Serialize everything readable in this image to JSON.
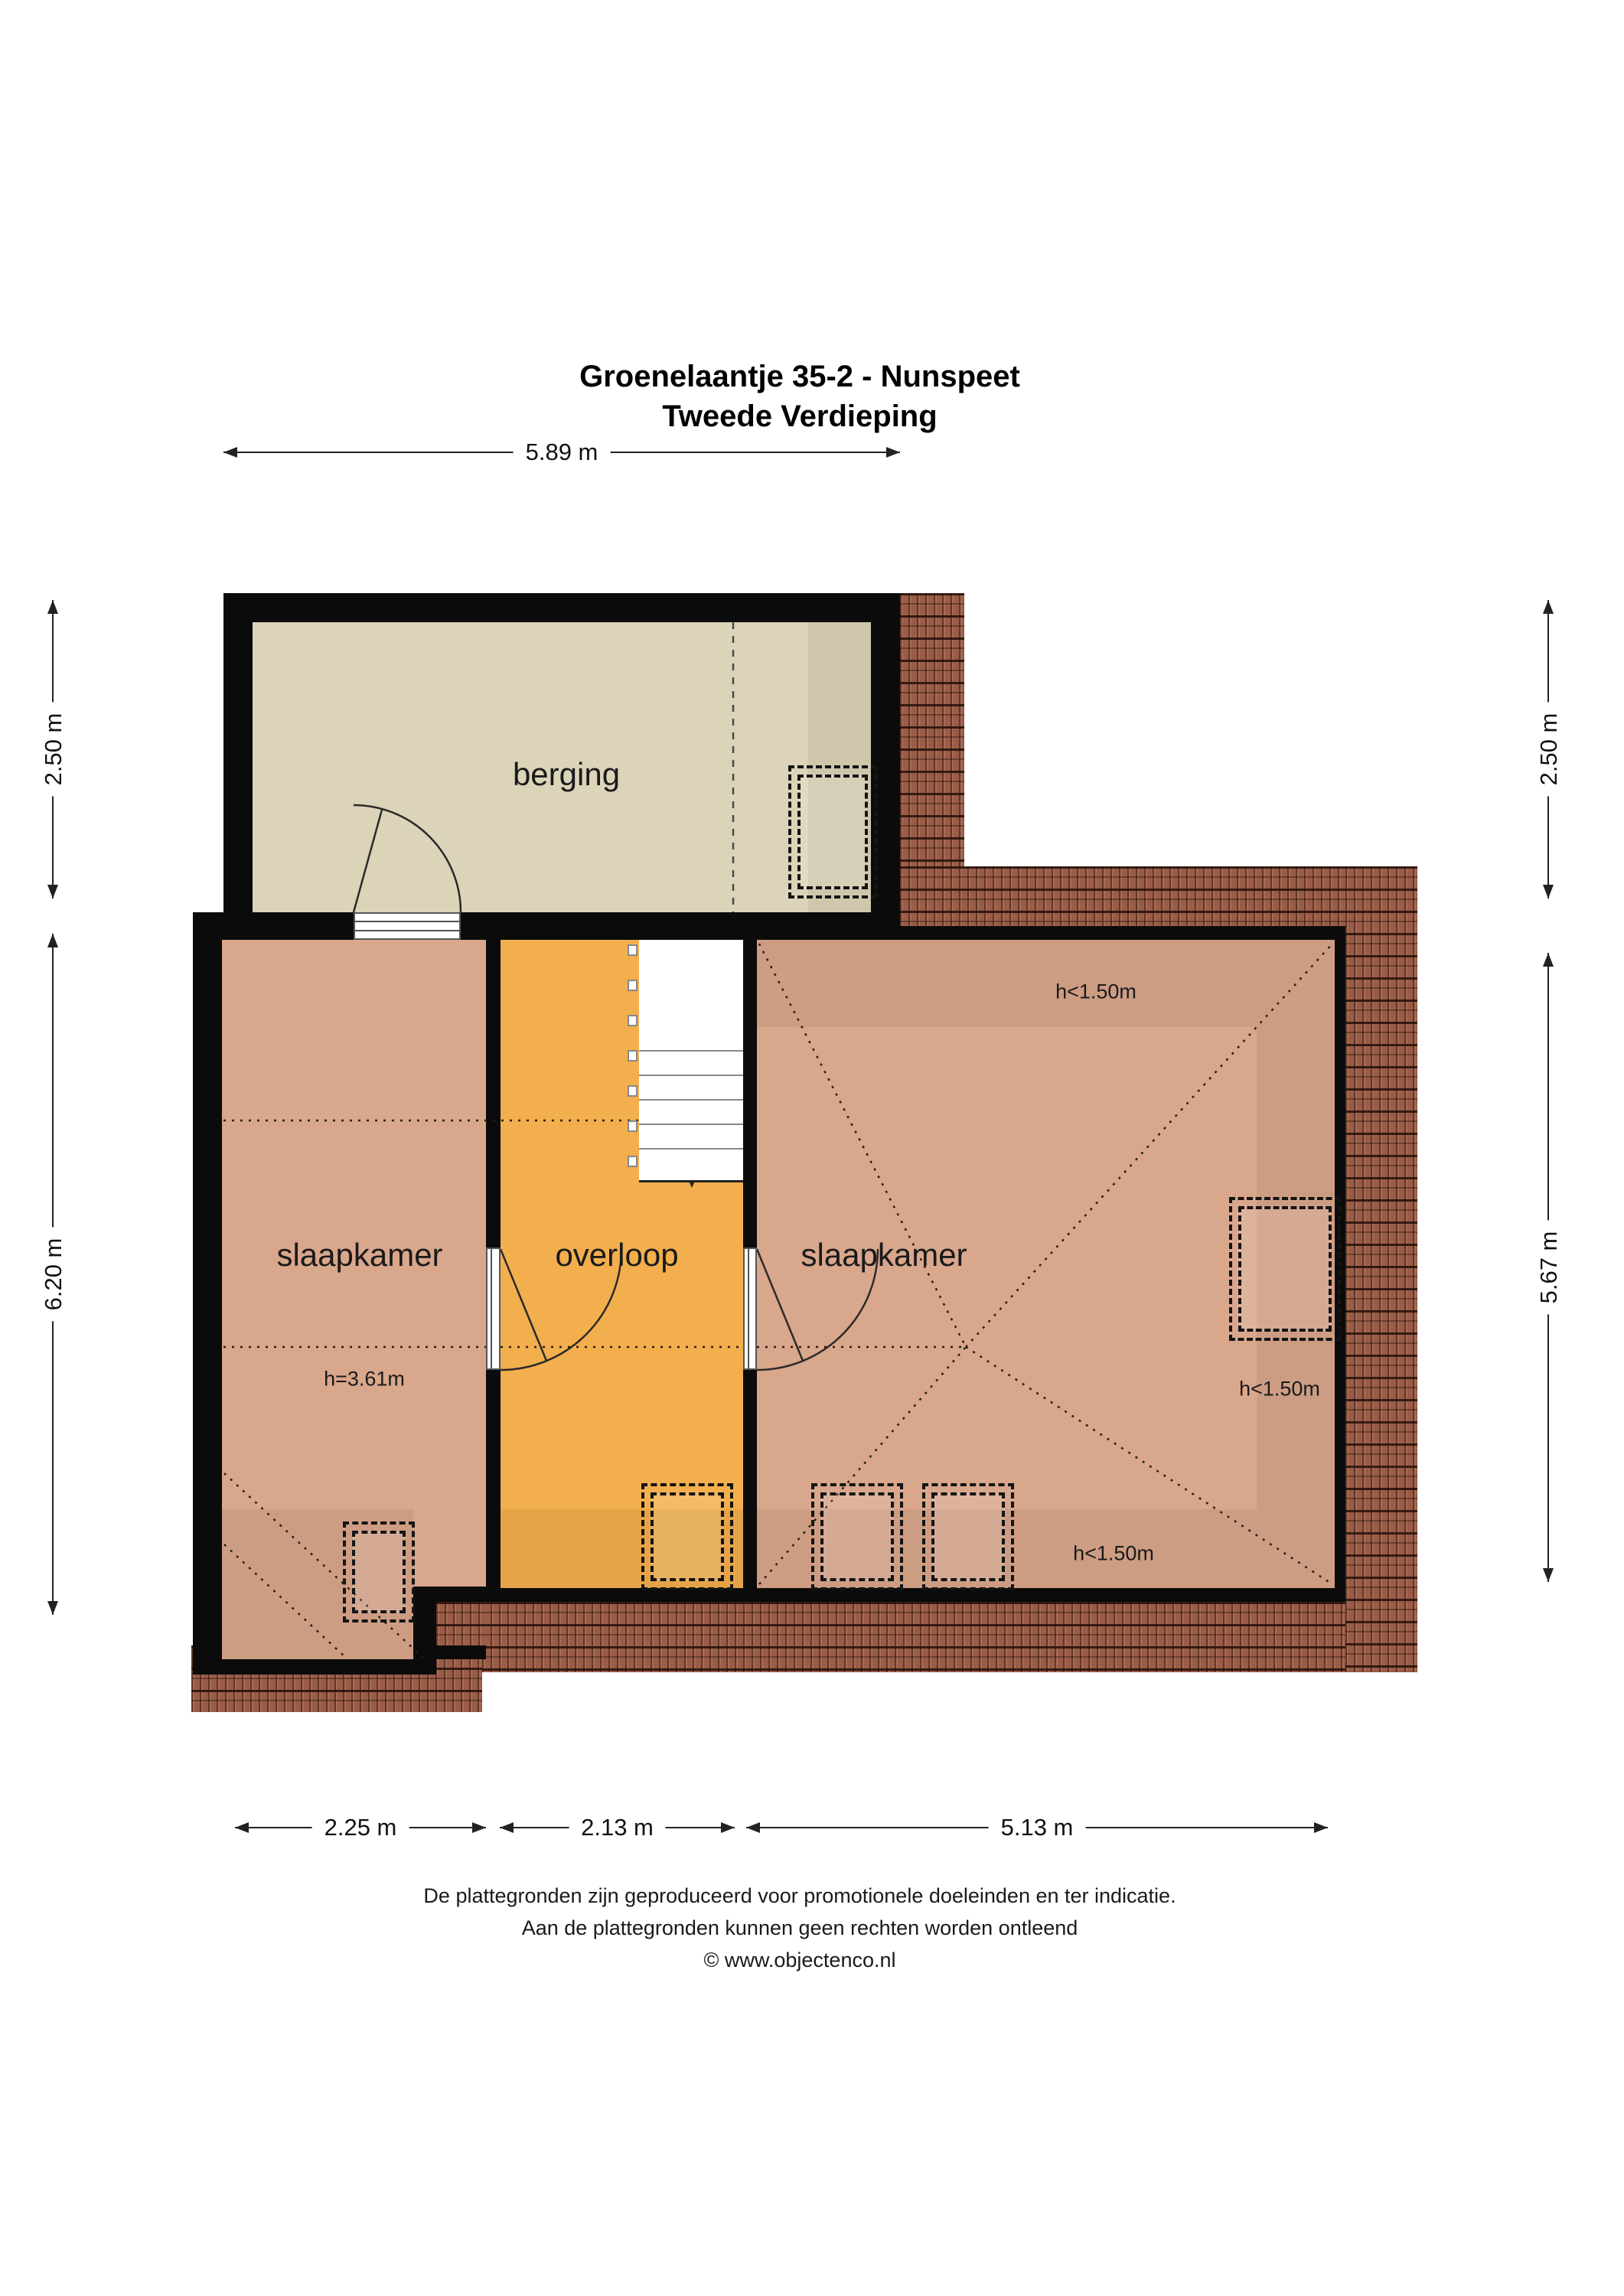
{
  "title": {
    "line1": "Groenelaantje 35-2 - Nunspeet",
    "line2": "Tweede Verdieping"
  },
  "rooms": {
    "berging": "berging",
    "slaapkamer_left": "slaapkamer",
    "overloop": "overloop",
    "slaapkamer_right": "slaapkamer"
  },
  "height_labels": {
    "left_room": "h=3.61m",
    "right_top": "h<1.50m",
    "right_side": "h<1.50m",
    "right_bottom": "h<1.50m"
  },
  "dimensions": {
    "top": "5.89 m",
    "left_upper": "2.50 m",
    "left_lower": "6.20 m",
    "right_upper": "2.50 m",
    "right_lower": "5.67 m",
    "bottom_left": "2.25 m",
    "bottom_middle": "2.13 m",
    "bottom_right": "5.13 m"
  },
  "footer": {
    "line1": "De plattegronden zijn geproduceerd voor promotionele doeleinden en ter indicatie.",
    "line2": "Aan de plattegronden kunnen geen rechten worden ontleend",
    "line3": "© www.objectenco.nl"
  },
  "colors": {
    "wall": "#0b0b0b",
    "berging_fill": "#dbd4b9",
    "bedroom_fill": "#d9a78c",
    "overloop_fill": "#f3af4d",
    "roof_tile": "#9a5c46",
    "dimension_line": "#222222"
  }
}
